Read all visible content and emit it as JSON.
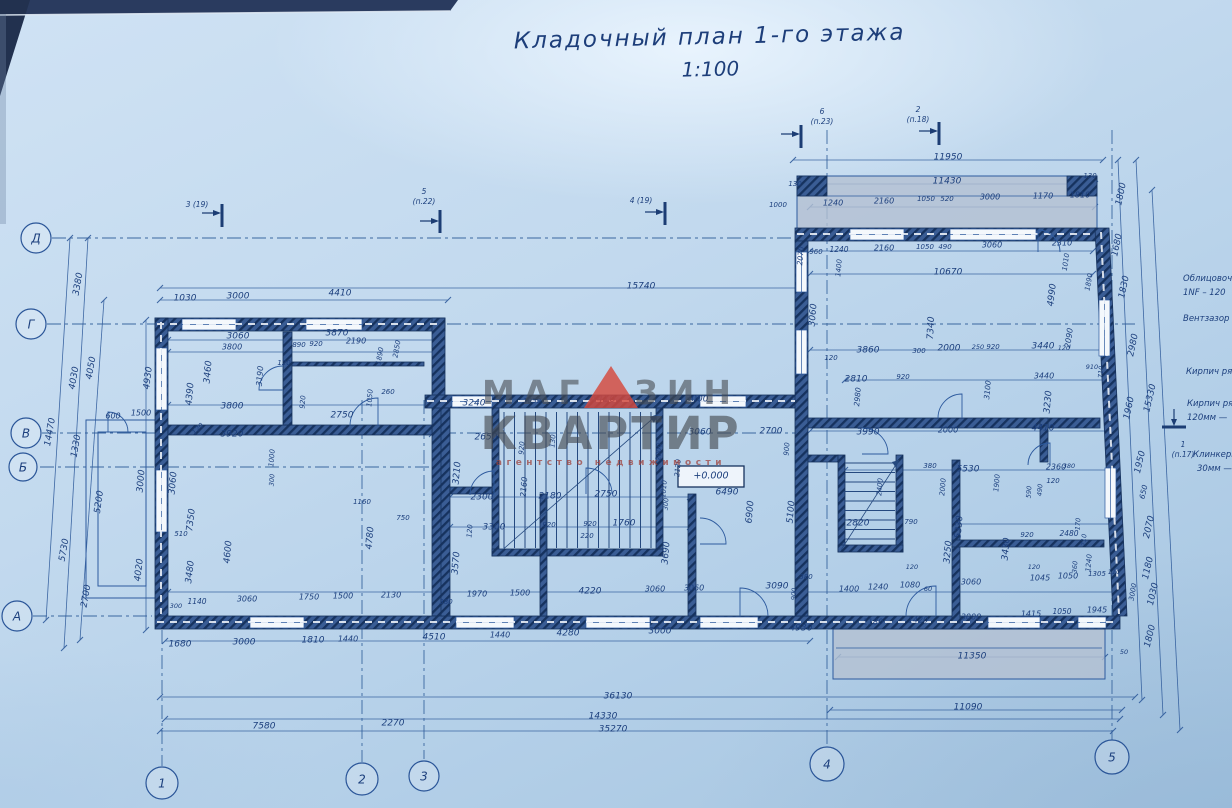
{
  "title": {
    "line1": "Кладочный план 1-го этажа",
    "scale": "1:100"
  },
  "watermark": {
    "part1": "МАГ",
    "part2": "ЗИН",
    "line2": "КВАРТИР",
    "line3": "агентство  недвижимости",
    "triangle_color": "#d6483c"
  },
  "colors": {
    "paper": "#c2d9ee",
    "ink": "#1c3f7d",
    "wall": "#3a5d95",
    "wall_dark": "#16325e",
    "red_mark": "#b8392f"
  },
  "plan": {
    "elevation": "+0.000"
  },
  "legend": [
    [
      "Облицовоч",
      1183,
      281
    ],
    [
      "1NF – 120",
      1183,
      295
    ],
    [
      "Вентзазор",
      1183,
      321
    ],
    [
      "Кирпич ря",
      1186,
      374
    ],
    [
      "Кирпич ря",
      1187,
      406
    ],
    [
      "120мм —",
      1187,
      420
    ],
    [
      "Клинкерн",
      1193,
      457
    ],
    [
      "30мм —",
      1197,
      471
    ]
  ],
  "axis_bubbles": [
    {
      "label": "Д",
      "x": 36,
      "y": 238,
      "r": 15
    },
    {
      "label": "Г",
      "x": 31,
      "y": 324,
      "r": 15
    },
    {
      "label": "В",
      "x": 26,
      "y": 433,
      "r": 15
    },
    {
      "label": "Б",
      "x": 23,
      "y": 467,
      "r": 14
    },
    {
      "label": "А",
      "x": 17,
      "y": 616,
      "r": 15
    },
    {
      "label": "1",
      "x": 162,
      "y": 783,
      "r": 16
    },
    {
      "label": "2",
      "x": 362,
      "y": 779,
      "r": 16
    },
    {
      "label": "3",
      "x": 424,
      "y": 776,
      "r": 15
    },
    {
      "label": "4",
      "x": 827,
      "y": 764,
      "r": 17
    },
    {
      "label": "5",
      "x": 1112,
      "y": 757,
      "r": 17
    }
  ],
  "section_markers": [
    {
      "lines": [
        "3 (19)"
      ],
      "x": 197,
      "y": 207
    },
    {
      "lines": [
        "5",
        "(п.22)"
      ],
      "x": 424,
      "y": 194
    },
    {
      "lines": [
        "4 (19)"
      ],
      "x": 641,
      "y": 203
    },
    {
      "lines": [
        "6",
        "(п.23)"
      ],
      "x": 822,
      "y": 114
    },
    {
      "lines": [
        "2",
        "(п.18)"
      ],
      "x": 918,
      "y": 112
    },
    {
      "lines": [
        "1",
        "(п.17)"
      ],
      "x": 1183,
      "y": 447
    }
  ],
  "dimensions": [
    [
      "1030",
      185,
      298
    ],
    [
      "3000",
      238,
      296
    ],
    [
      "4410",
      340,
      293
    ],
    [
      "15740",
      641,
      286
    ],
    [
      "3060",
      238,
      336
    ],
    [
      "3870",
      337,
      333
    ],
    [
      "3800",
      232,
      347,
      0,
      8
    ],
    [
      "890",
      299,
      345,
      0,
      7
    ],
    [
      "920",
      316,
      344,
      0,
      7
    ],
    [
      "2190",
      356,
      341,
      0,
      8
    ],
    [
      "1890",
      380,
      356,
      -80,
      7
    ],
    [
      "2850",
      397,
      349,
      -80,
      7
    ],
    [
      "3460",
      208,
      372,
      -85
    ],
    [
      "4390",
      190,
      394,
      -85
    ],
    [
      "3190",
      260,
      376,
      -85,
      8
    ],
    [
      "120",
      284,
      363,
      0,
      7
    ],
    [
      "3800",
      232,
      406
    ],
    [
      "920",
      303,
      402,
      -85,
      7
    ],
    [
      "2750",
      342,
      415
    ],
    [
      "1050",
      370,
      398,
      -85,
      7
    ],
    [
      "260",
      388,
      392,
      0,
      7
    ],
    [
      "3920",
      232,
      434
    ],
    [
      "120",
      198,
      429,
      -45,
      7
    ],
    [
      "1160",
      362,
      502,
      0,
      7
    ],
    [
      "750",
      403,
      518,
      0,
      7
    ],
    [
      "1000",
      272,
      458,
      -85,
      7
    ],
    [
      "300",
      272,
      480,
      -85,
      6.5
    ],
    [
      "4600",
      228,
      552,
      -85
    ],
    [
      "4780",
      370,
      538,
      -85
    ],
    [
      "3570",
      456,
      563,
      -85
    ],
    [
      "3690",
      666,
      553,
      -85
    ],
    [
      "4930",
      148,
      378,
      -83
    ],
    [
      "3060",
      173,
      483,
      -85
    ],
    [
      "7350",
      191,
      520,
      -83
    ],
    [
      "510",
      181,
      534,
      0,
      7
    ],
    [
      "3480",
      190,
      572,
      -83
    ],
    [
      "3000",
      141,
      481,
      -85
    ],
    [
      "600",
      113,
      416,
      0,
      8
    ],
    [
      "1500",
      141,
      413,
      0,
      8
    ],
    [
      "4020",
      139,
      570,
      -83
    ],
    [
      "5200",
      99,
      502,
      -82
    ],
    [
      "5730",
      64,
      550,
      -80
    ],
    [
      "2700",
      86,
      596,
      -80
    ],
    [
      "1330",
      76,
      446,
      -80
    ],
    [
      "14470",
      50,
      432,
      -80
    ],
    [
      "4030",
      74,
      378,
      -80
    ],
    [
      "4050",
      91,
      368,
      -80
    ],
    [
      "3380",
      78,
      284,
      -80
    ],
    [
      "3240",
      474,
      403
    ],
    [
      "1050",
      532,
      401,
      0,
      7
    ],
    [
      "2650",
      486,
      437
    ],
    [
      "920",
      522,
      448,
      -85,
      7
    ],
    [
      "130",
      553,
      441,
      -85,
      7
    ],
    [
      "3000",
      697,
      399
    ],
    [
      "3060",
      700,
      432
    ],
    [
      "2700",
      771,
      431
    ],
    [
      "900",
      787,
      449,
      -85,
      7
    ],
    [
      "3210",
      457,
      473,
      -85
    ],
    [
      "2160",
      524,
      487,
      -85,
      8
    ],
    [
      "2300",
      482,
      497
    ],
    [
      "2180",
      550,
      496
    ],
    [
      "2750",
      606,
      494
    ],
    [
      "1010",
      664,
      489,
      -85,
      7
    ],
    [
      "300",
      666,
      504,
      -85,
      6.5
    ],
    [
      "2000",
      659,
      452,
      -85,
      7
    ],
    [
      "2120",
      678,
      468,
      -85,
      7
    ],
    [
      "6490",
      727,
      492
    ],
    [
      "6900",
      750,
      512,
      -85
    ],
    [
      "5100",
      791,
      512,
      -85
    ],
    [
      "3300",
      494,
      527
    ],
    [
      "120",
      470,
      531,
      -85,
      7
    ],
    [
      "920",
      549,
      525,
      0,
      7
    ],
    [
      "920",
      590,
      524,
      0,
      7
    ],
    [
      "220",
      587,
      536,
      0,
      7
    ],
    [
      "1760",
      624,
      523
    ],
    [
      "1970",
      477,
      594,
      0,
      8
    ],
    [
      "1500",
      520,
      593,
      0,
      8
    ],
    [
      "4220",
      590,
      591
    ],
    [
      "3060",
      655,
      589,
      0,
      8
    ],
    [
      "+0.000",
      711,
      476,
      0,
      9.5
    ],
    [
      "300",
      176,
      606,
      0,
      6.5
    ],
    [
      "1140",
      197,
      602,
      0,
      7.5
    ],
    [
      "3060",
      247,
      599,
      0,
      8
    ],
    [
      "1750",
      309,
      597,
      0,
      8
    ],
    [
      "1500",
      343,
      596,
      0,
      8
    ],
    [
      "2130",
      391,
      595,
      0,
      8
    ],
    [
      "380",
      446,
      602,
      0,
      7
    ],
    [
      "1680",
      180,
      644
    ],
    [
      "3000",
      244,
      642
    ],
    [
      "1810",
      313,
      640
    ],
    [
      "1440",
      348,
      639,
      0,
      8
    ],
    [
      "4510",
      434,
      637
    ],
    [
      "1440",
      500,
      635,
      0,
      8
    ],
    [
      "4280",
      568,
      633
    ],
    [
      "3000",
      660,
      631
    ],
    [
      "4930",
      801,
      628
    ],
    [
      "3060",
      694,
      588,
      0,
      8
    ],
    [
      "3090",
      777,
      586
    ],
    [
      "380",
      806,
      577,
      0,
      7
    ],
    [
      "900",
      794,
      594,
      -85,
      6.5
    ],
    [
      "1400",
      849,
      589,
      0,
      8
    ],
    [
      "1240",
      878,
      587,
      0,
      8
    ],
    [
      "1080",
      910,
      585,
      0,
      8
    ],
    [
      "60",
      928,
      589,
      0,
      6.5
    ],
    [
      "120",
      912,
      567,
      0,
      6.5
    ],
    [
      "3060",
      971,
      582,
      0,
      8
    ],
    [
      "120",
      1034,
      567,
      0,
      6.5
    ],
    [
      "1045",
      1040,
      578,
      0,
      8
    ],
    [
      "1050",
      1068,
      576,
      0,
      8
    ],
    [
      "1305",
      1097,
      574,
      0,
      7
    ],
    [
      "110",
      1114,
      572,
      0,
      6.5
    ],
    [
      "360",
      1075,
      567,
      -85,
      6.5
    ],
    [
      "1240",
      1089,
      563,
      -85,
      7
    ],
    [
      "1180",
      873,
      622,
      0,
      8
    ],
    [
      "1420",
      918,
      620,
      0,
      8
    ],
    [
      "3000",
      971,
      617,
      0,
      8
    ],
    [
      "1415",
      1031,
      614,
      0,
      8
    ],
    [
      "1050",
      1062,
      612,
      0,
      7.5
    ],
    [
      "1945",
      1097,
      610,
      0,
      8
    ],
    [
      "11350",
      972,
      656
    ],
    [
      "36130",
      618,
      696
    ],
    [
      "14330",
      603,
      716
    ],
    [
      "7580",
      264,
      726
    ],
    [
      "2270",
      393,
      723
    ],
    [
      "35270",
      613,
      729
    ],
    [
      "11090",
      968,
      707
    ],
    [
      "1800",
      1150,
      636,
      -76
    ],
    [
      "50",
      1124,
      652,
      0,
      6.5
    ],
    [
      "3000",
      1133,
      592,
      -80,
      7
    ],
    [
      "1030",
      1153,
      594,
      -77
    ],
    [
      "1180",
      1148,
      568,
      -77
    ],
    [
      "2070",
      1149,
      527,
      -77
    ],
    [
      "650",
      1144,
      492,
      -77,
      7.5
    ],
    [
      "1950",
      1140,
      462,
      -77
    ],
    [
      "11950",
      948,
      157
    ],
    [
      "11430",
      947,
      181
    ],
    [
      "130",
      795,
      184,
      0,
      7
    ],
    [
      "130",
      1090,
      176,
      0,
      7
    ],
    [
      "1800",
      1121,
      194,
      -78
    ],
    [
      "1000",
      778,
      205,
      0,
      7
    ],
    [
      "1240",
      833,
      203,
      0,
      8
    ],
    [
      "2160",
      884,
      201,
      0,
      8
    ],
    [
      "1050",
      926,
      199,
      0,
      7
    ],
    [
      "520",
      947,
      199,
      0,
      7
    ],
    [
      "3000",
      990,
      197,
      0,
      8
    ],
    [
      "1170",
      1043,
      196,
      0,
      8
    ],
    [
      "1810",
      1080,
      195,
      0,
      8
    ],
    [
      "2070",
      801,
      256,
      -85,
      7.5
    ],
    [
      "960",
      816,
      252,
      0,
      7
    ],
    [
      "1240",
      839,
      250,
      0,
      7.5
    ],
    [
      "2160",
      884,
      248,
      0,
      8
    ],
    [
      "1050",
      925,
      247,
      0,
      7
    ],
    [
      "490",
      945,
      247,
      0,
      7
    ],
    [
      "3060",
      992,
      245,
      0,
      8
    ],
    [
      "2310",
      1062,
      243,
      0,
      8
    ],
    [
      "1010",
      1066,
      262,
      -82,
      7
    ],
    [
      "1400",
      839,
      268,
      -85,
      7
    ],
    [
      "10670",
      948,
      272
    ],
    [
      "1890",
      1089,
      282,
      -80,
      7
    ],
    [
      "4990",
      1052,
      295,
      -83
    ],
    [
      "1830",
      1124,
      287,
      -78
    ],
    [
      "1680",
      1117,
      245,
      -78
    ],
    [
      "3060",
      813,
      315,
      -85
    ],
    [
      "7340",
      931,
      328,
      -87
    ],
    [
      "2090",
      1069,
      338,
      -82,
      8
    ],
    [
      "2980",
      1133,
      345,
      -78
    ],
    [
      "15330",
      1150,
      398,
      -77
    ],
    [
      "1960",
      1129,
      408,
      -78
    ],
    [
      "3860",
      868,
      350
    ],
    [
      "300",
      919,
      351,
      0,
      7
    ],
    [
      "2000",
      949,
      348
    ],
    [
      "250",
      978,
      347,
      0,
      6.5
    ],
    [
      "920",
      993,
      347,
      0,
      7
    ],
    [
      "3440",
      1043,
      346
    ],
    [
      "120",
      1064,
      348,
      0,
      6.5
    ],
    [
      "120",
      831,
      358,
      0,
      7
    ],
    [
      "2810",
      856,
      379
    ],
    [
      "920",
      903,
      377,
      0,
      7
    ],
    [
      "2980",
      858,
      397,
      -85,
      7.5
    ],
    [
      "3100",
      988,
      390,
      -85,
      7.5
    ],
    [
      "3230",
      1048,
      402,
      -85
    ],
    [
      "3440",
      1044,
      376,
      0,
      8
    ],
    [
      "910",
      1092,
      367,
      0,
      6.5
    ],
    [
      "710",
      1101,
      372,
      -85,
      6.5
    ],
    [
      "3990",
      868,
      432
    ],
    [
      "2000",
      948,
      430,
      0,
      8
    ],
    [
      "4410",
      1043,
      428
    ],
    [
      "5530",
      968,
      469
    ],
    [
      "380",
      930,
      466,
      0,
      7
    ],
    [
      "1900",
      997,
      483,
      -85,
      7
    ],
    [
      "2360",
      1056,
      467,
      0,
      8
    ],
    [
      "380",
      1069,
      466,
      0,
      6.5
    ],
    [
      "120",
      1053,
      481,
      0,
      7
    ],
    [
      "590",
      1029,
      492,
      -85,
      6.5
    ],
    [
      "2400",
      880,
      487,
      -85,
      7
    ],
    [
      "2000",
      943,
      487,
      -85,
      7
    ],
    [
      "490",
      1040,
      490,
      -85,
      6.5
    ],
    [
      "2820",
      858,
      523
    ],
    [
      "790",
      911,
      522,
      0,
      7
    ],
    [
      "5330",
      959,
      527,
      -85
    ],
    [
      "3430",
      1006,
      549,
      -85
    ],
    [
      "2480",
      1069,
      534,
      0,
      7.5
    ],
    [
      "170",
      1078,
      524,
      -85,
      6.5
    ],
    [
      "710",
      1084,
      540,
      -85,
      6.5
    ],
    [
      "920",
      1027,
      535,
      0,
      7
    ],
    [
      "3250",
      948,
      552,
      -85
    ],
    [
      "4410",
      603,
      399,
      0,
      10,
      "#b8392f"
    ]
  ]
}
